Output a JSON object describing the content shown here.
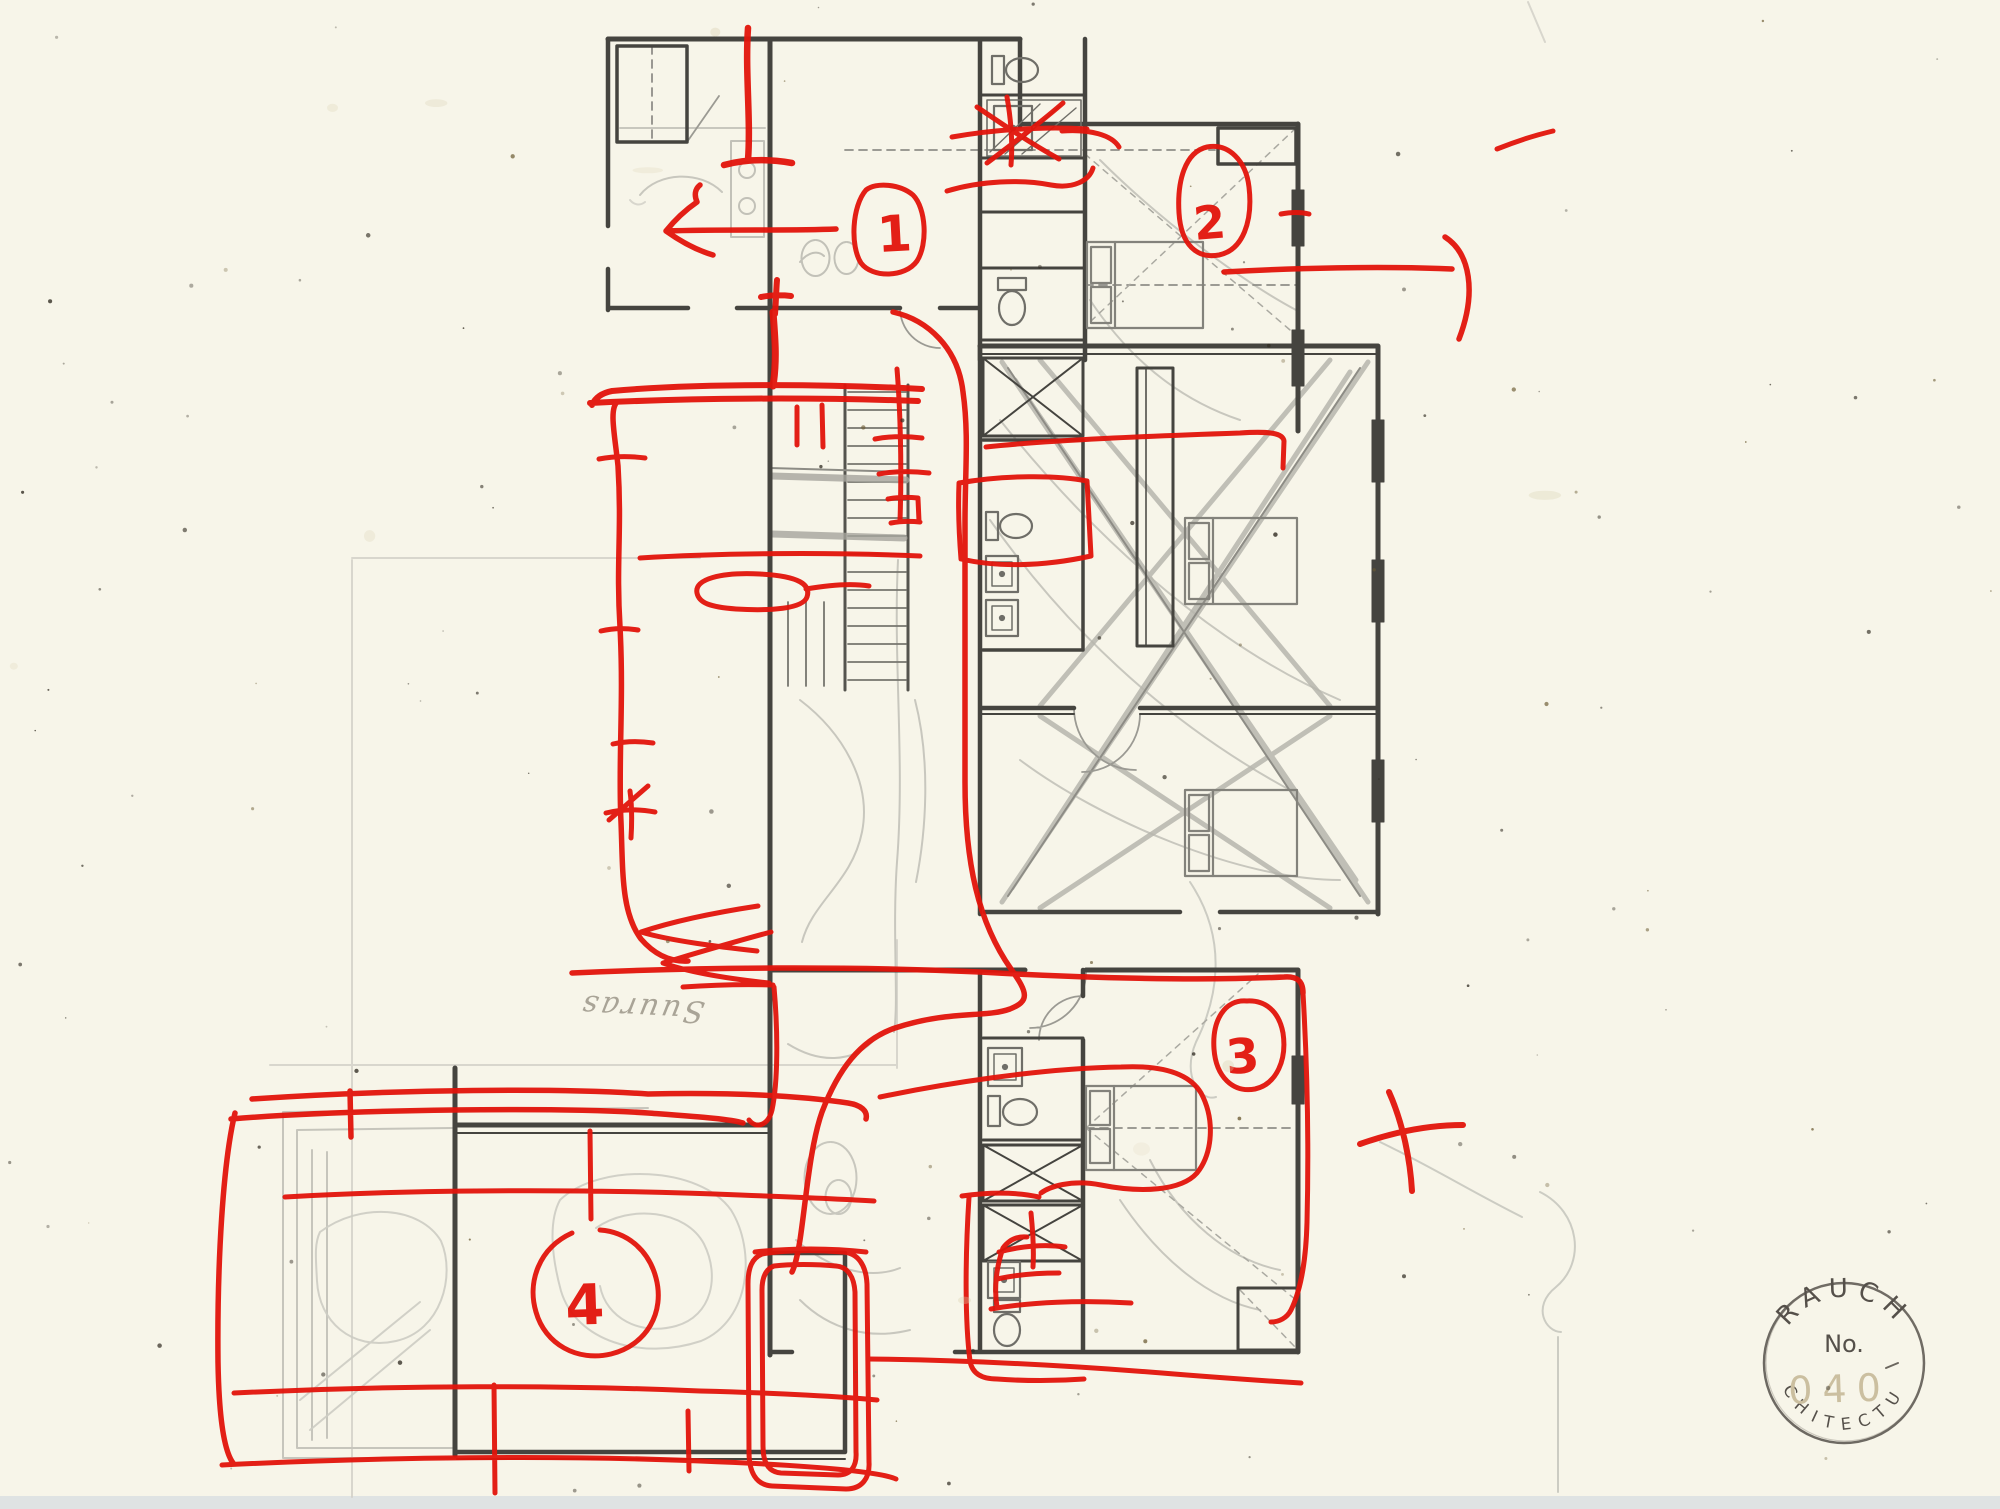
{
  "colors": {
    "paper": "#f7f5e9",
    "marker_red": "#e2140b",
    "pencil_dark": "#45443f",
    "pencil_light": "#b9b8b0",
    "stamp_ink": "#55504a",
    "stamp_number_faint": "#cbbfa0",
    "scan_edge": "#dfe3e3"
  },
  "annotations": {
    "room_numbers": [
      {
        "label": "1"
      },
      {
        "label": "2"
      },
      {
        "label": "3"
      },
      {
        "label": "4"
      }
    ],
    "pencil_note": "Suuras"
  },
  "stamp": {
    "name_top": "RAUCH",
    "name_bottom": "ARCHITECTURE",
    "number_label": "No.",
    "number_value": "040"
  }
}
